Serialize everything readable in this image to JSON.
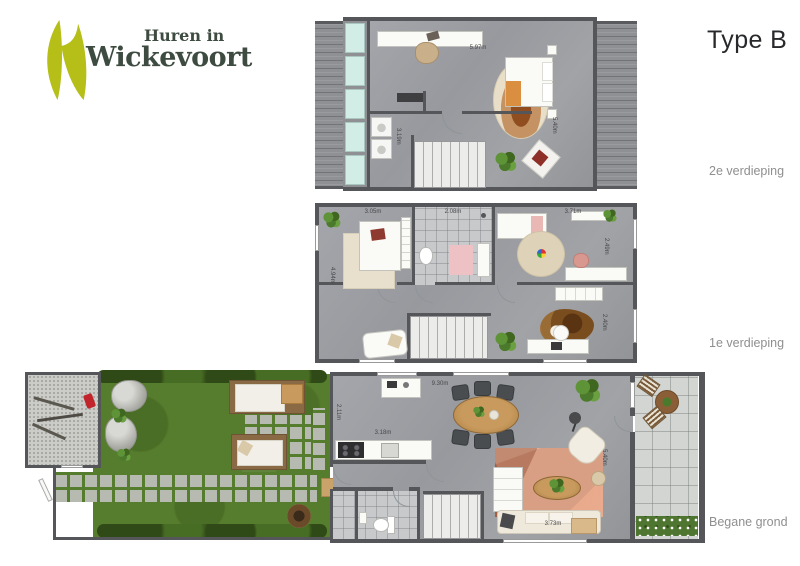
{
  "title": "Type B",
  "logo": {
    "line1": "Huren in",
    "line2": "Wickevoort"
  },
  "floors": [
    {
      "label": "2e verdieping",
      "dims": {
        "width_top": "5.97m",
        "laundry": "3.19m",
        "depth": "5.40m"
      }
    },
    {
      "label": "1e verdieping",
      "dims": {
        "bedroom": "3.05m",
        "bathroom": "2.08m",
        "kids_room": "3.71m",
        "left_depth": "4.94m",
        "right_upper": "2.49m",
        "right_lower": "2.40m"
      }
    },
    {
      "label": "Begane grond",
      "dims": {
        "width_top": "9.30m",
        "hall": "2.11m",
        "kitchen": "3.18m",
        "depth": "5.40m",
        "living": "3.73m"
      }
    }
  ],
  "colors": {
    "brand_green": "#b5bf17",
    "brand_dark": "#3d4b40",
    "label_gray": "#8f8f8f",
    "wall": "#55565a",
    "floor": "#9b9da2",
    "skylight": "#d2ece6",
    "lawn": "#567c2d",
    "living_rug": "#d99f85"
  }
}
